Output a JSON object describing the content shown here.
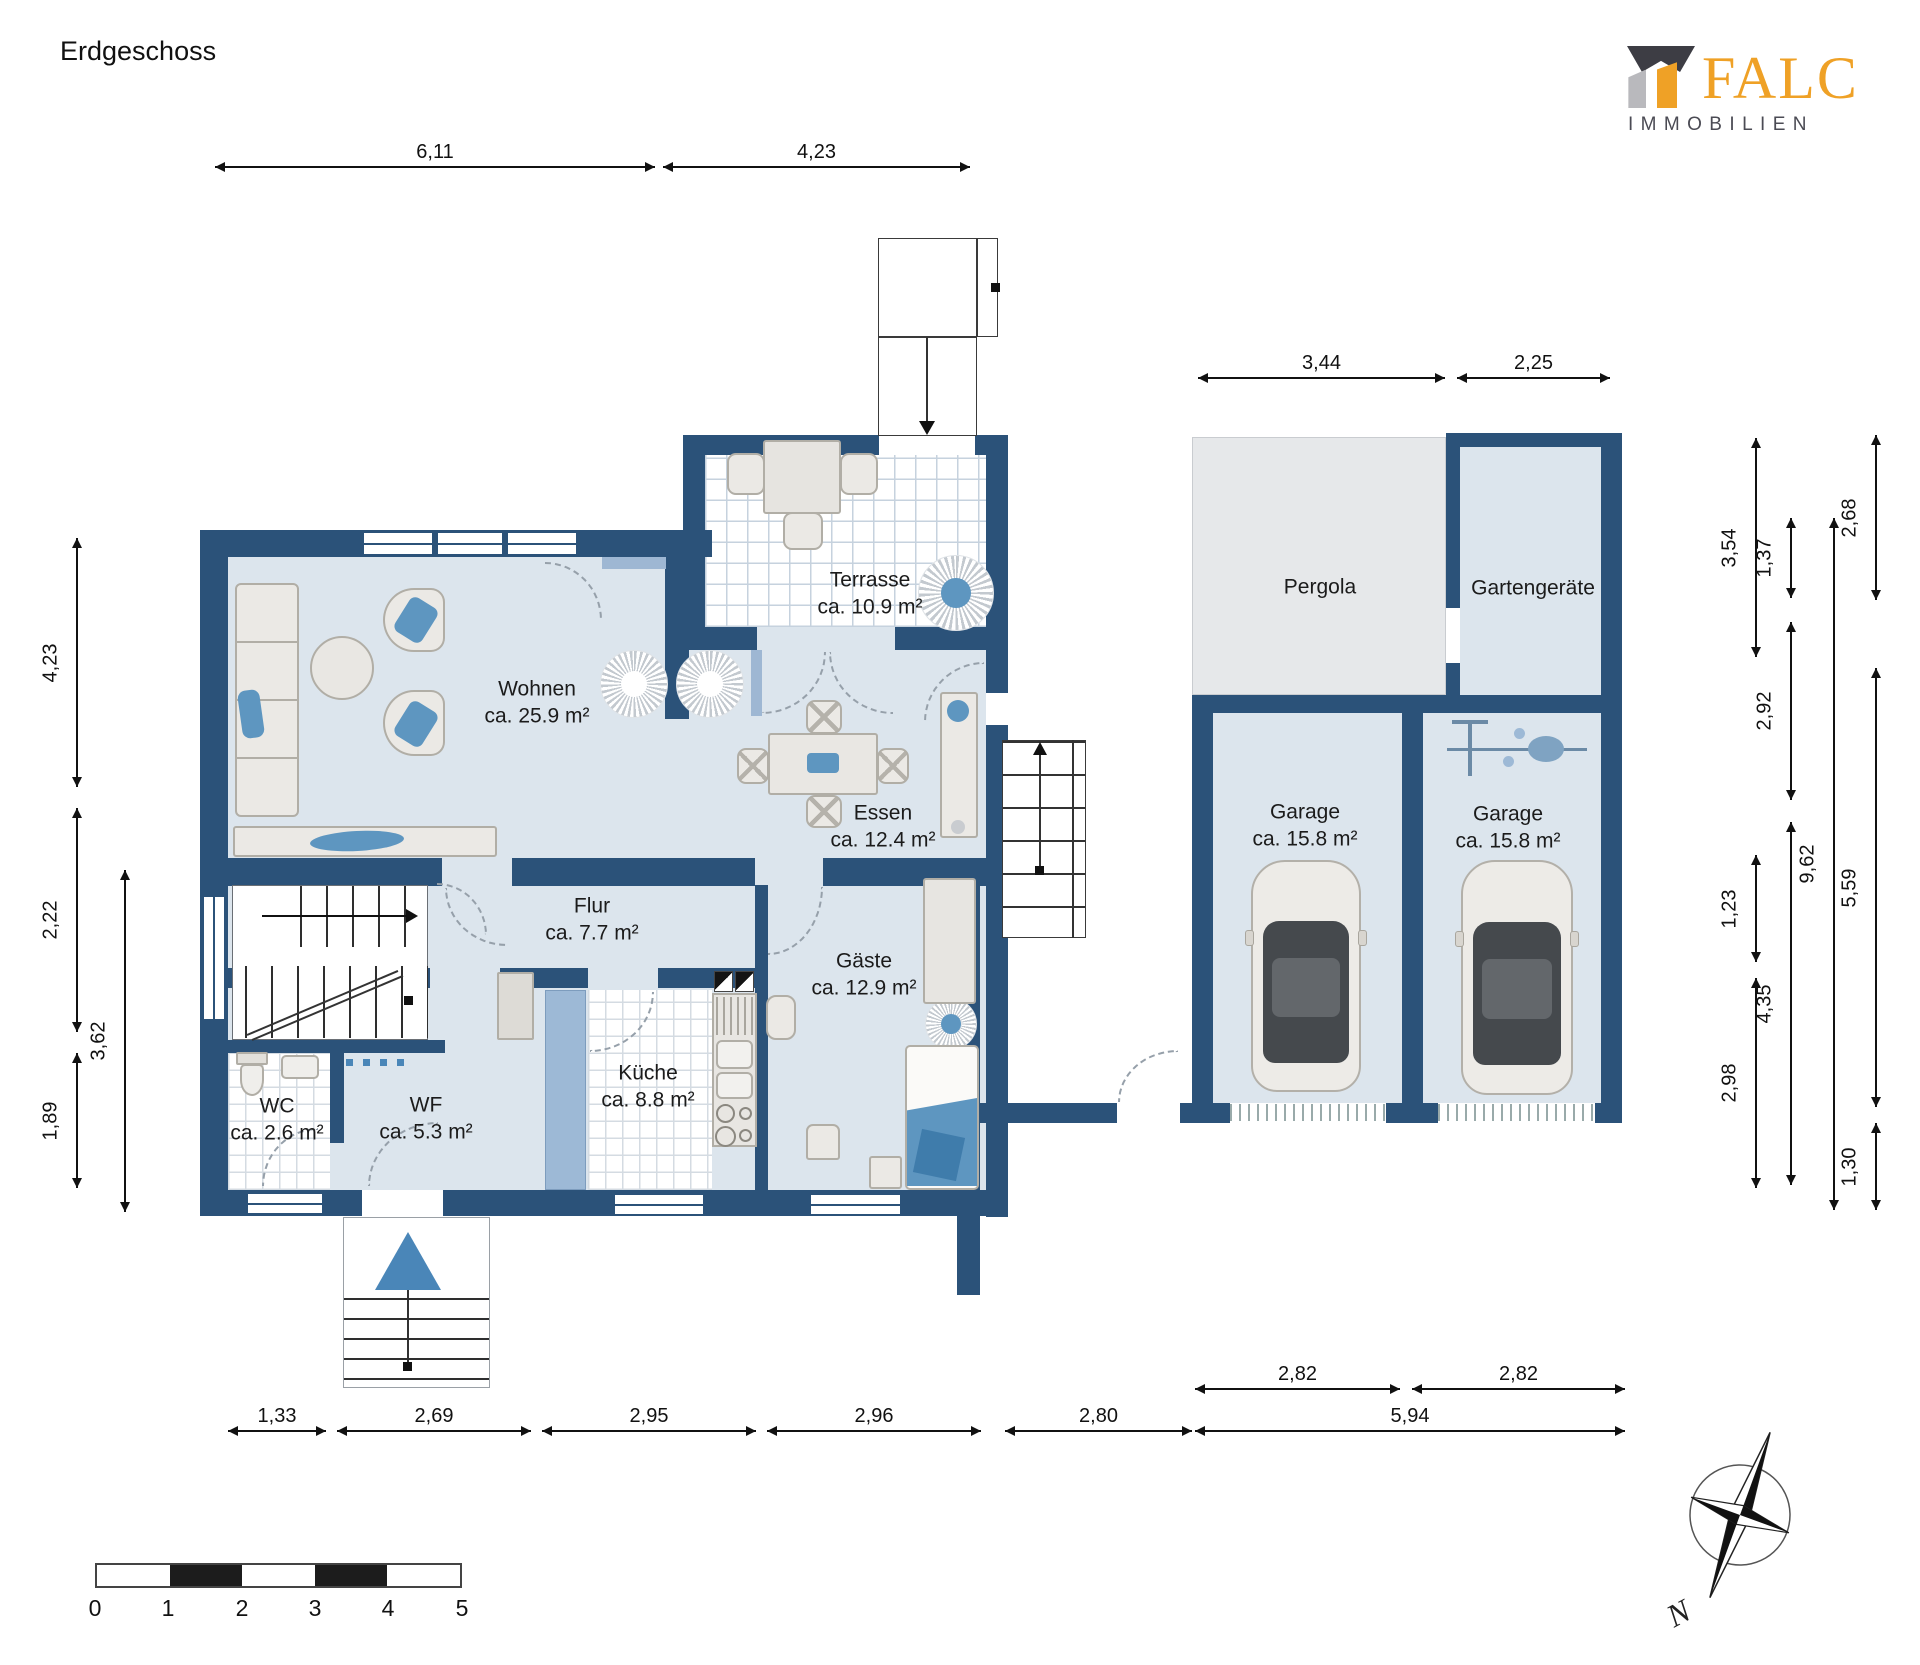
{
  "title": "Erdgeschoss",
  "logo": {
    "name": "FALC",
    "sub": "IMMOBILIEN",
    "orange": "#efa126",
    "dark": "#3d3d44",
    "gray": "#b9b9bd"
  },
  "rooms": {
    "wohnen": {
      "name": "Wohnen",
      "area": "ca. 25.9 m²"
    },
    "terrasse": {
      "name": "Terrasse",
      "area": "ca. 10.9 m²"
    },
    "essen": {
      "name": "Essen",
      "area": "ca. 12.4 m²"
    },
    "flur": {
      "name": "Flur",
      "area": "ca. 7.7 m²"
    },
    "gaeste": {
      "name": "Gäste",
      "area": "ca. 12.9 m²"
    },
    "wc": {
      "name": "WC",
      "area": "ca. 2.6 m²"
    },
    "wf": {
      "name": "WF",
      "area": "ca. 5.3 m²"
    },
    "kueche": {
      "name": "Küche",
      "area": "ca. 8.8 m²"
    },
    "pergola": {
      "name": "Pergola"
    },
    "gartengeraete": {
      "name": "Gartengeräte"
    },
    "garage1": {
      "name": "Garage",
      "area": "ca. 15.8 m²"
    },
    "garage2": {
      "name": "Garage",
      "area": "ca. 15.8 m²"
    }
  },
  "dimensions": {
    "top": [
      "6,11",
      "4,23"
    ],
    "garage_top": [
      "3,44",
      "2,25"
    ],
    "bottom": [
      "1,33",
      "2,69",
      "2,95",
      "2,96",
      "2,80",
      "5,94"
    ],
    "garage_bottom": [
      "2,82",
      "2,82"
    ],
    "left_outer": [
      "4,23",
      "2,22",
      "1,89"
    ],
    "left_inner": [
      "3,62"
    ],
    "right_col1": [
      "3,54",
      "1,23",
      "2,98"
    ],
    "right_col2": [
      "1,37",
      "2,92",
      "4,35"
    ],
    "right_col3": [
      "9,62"
    ],
    "right_col4": [
      "2,68",
      "5,59",
      "1,30"
    ]
  },
  "scale_bar": {
    "labels": [
      "0",
      "1",
      "2",
      "3",
      "4",
      "5"
    ]
  },
  "compass": {
    "north_label": "N"
  },
  "colors": {
    "wall": "#2b5279",
    "floor": "#dce5ed",
    "accent_blue": "#5e96c0",
    "pergola_gray": "#e6e8ea"
  }
}
